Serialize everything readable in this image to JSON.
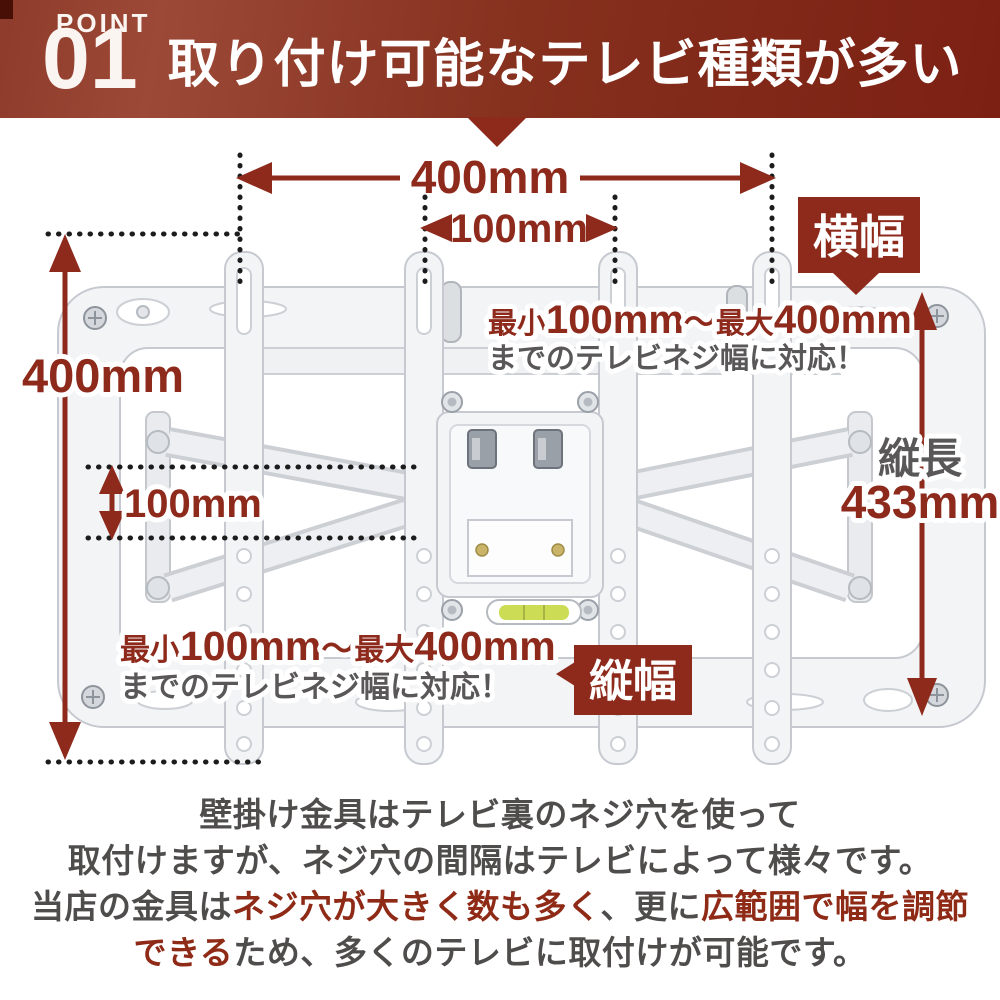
{
  "colors": {
    "accent_red": "#8e2a1c",
    "banner_left": "#9c4937",
    "banner_right": "#7c2013",
    "banner_notch": "#470f05",
    "text_gray": "#595757",
    "paragraph_gray": "#4f4c4c",
    "highlight_red": "#8e2a16",
    "badge_text": "#ffffff",
    "level_green": "#ccdd55",
    "bracket_white": "#f3f4f6",
    "bracket_edge": "#c6cad0"
  },
  "header": {
    "point_label": "POINT",
    "point_number": "01",
    "title": "取り付け可能なテレビ種類が多い"
  },
  "badges": {
    "width": "横幅",
    "height": "縦幅"
  },
  "dimensions": {
    "top_width": "400mm",
    "top_inner_width": "100mm",
    "left_height": "400mm",
    "left_inner_height": "100mm",
    "right_label": "縦長",
    "right_value": "433mm"
  },
  "notes": {
    "top": {
      "min_label": "最小",
      "min_value": "100mm",
      "tilde": "〜",
      "max_label": "最大",
      "max_value": "400mm",
      "line2": "までのテレビネジ幅に対応！"
    },
    "bottom": {
      "min_label": "最小",
      "min_value": "100mm",
      "tilde": "〜",
      "max_label": "最大",
      "max_value": "400mm",
      "line2": "までのテレビネジ幅に対応！"
    }
  },
  "paragraph": {
    "line1": "壁掛け金具はテレビ裏のネジ穴を使って",
    "line2": "取付けますが、ネジ穴の間隔はテレビによって様々です。",
    "line3_part1": "当店の金具は",
    "line3_red1": "ネジ穴が大きく数も多く",
    "line3_part2": "、更に",
    "line3_red2": "広範囲で幅を調節",
    "line4_red": "できる",
    "line4_part": "ため、多くのテレビに取付けが可能です。"
  }
}
